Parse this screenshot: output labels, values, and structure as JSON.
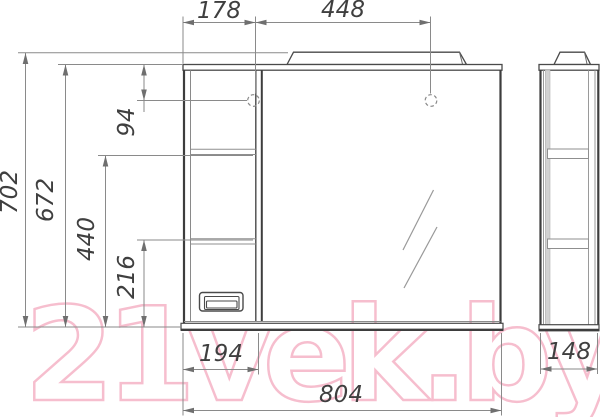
{
  "watermark": {
    "text": "21vek.by",
    "color": "#f5aec2"
  },
  "colors": {
    "outline": "#3d3d3d",
    "dimension_lines": "#8a8a8a",
    "dimension_text": "#3f3f3f",
    "watermark": "#f5aec2",
    "panel_shade": "#d2d2d2"
  },
  "dims": {
    "hole_left_offset": "178",
    "hole_spacing": "448",
    "overall_height": "702",
    "cabinet_height": "672",
    "hole_top_offset": "94",
    "upper_shelf_height": "440",
    "lower_shelf_height": "216",
    "left_section_width": "194",
    "overall_width": "804",
    "side_depth": "148"
  }
}
